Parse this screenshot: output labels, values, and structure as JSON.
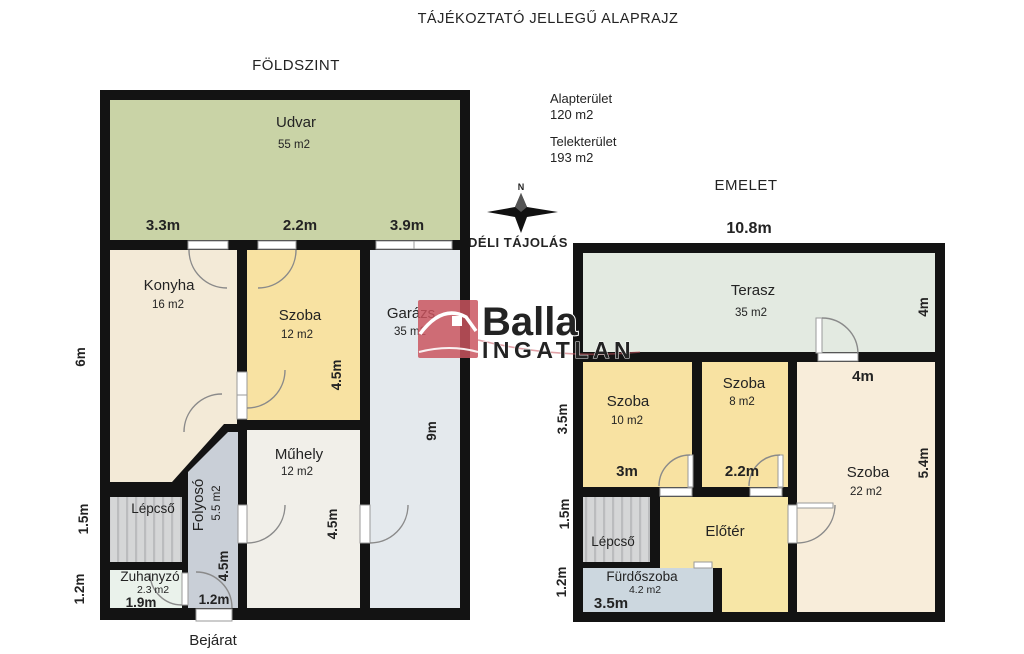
{
  "title": "TÁJÉKOZTATÓ JELLEGŰ ALAPRAJZ",
  "info": {
    "area_label": "Alapterület",
    "area_value": "120 m2",
    "lot_label": "Telekterület",
    "lot_value": "193 m2"
  },
  "compass": {
    "north": "N",
    "label": "DÉLI TÁJOLÁS"
  },
  "logo": {
    "brand": "Balla",
    "sub": "INGATLAN"
  },
  "ground": {
    "title": "FÖLDSZINT",
    "entrance": "Bejárat",
    "rooms": [
      {
        "name": "Udvar",
        "area": "55 m2"
      },
      {
        "name": "Konyha",
        "area": "16 m2"
      },
      {
        "name": "Szoba",
        "area": "12 m2"
      },
      {
        "name": "Garázs",
        "area": "35 m2"
      },
      {
        "name": "Műhely",
        "area": "12 m2"
      },
      {
        "name": "Folyosó",
        "area": "5.5 m2"
      },
      {
        "name": "Lépcső"
      },
      {
        "name": "Zuhanyzó",
        "area": "2.3 m2"
      }
    ],
    "dims": {
      "top": [
        "3.3m",
        "2.2m",
        "3.9m"
      ],
      "left": [
        "6m",
        "1.5m",
        "1.2m"
      ],
      "szoba_h": "4.5m",
      "muhely_h": "4.5m",
      "folyoso_h": "4.5m",
      "garazs_h": "9m",
      "zuhanyzo_w": "1.9m",
      "bejarat_w": "1.2m"
    }
  },
  "upper": {
    "title": "EMELET",
    "rooms": [
      {
        "name": "Terasz",
        "area": "35 m2"
      },
      {
        "name": "Szoba",
        "area": "10 m2"
      },
      {
        "name": "Szoba",
        "area": "8 m2"
      },
      {
        "name": "Szoba",
        "area": "22 m2"
      },
      {
        "name": "Előtér"
      },
      {
        "name": "Lépcső"
      },
      {
        "name": "Fürdőszoba",
        "area": "4.2 m2"
      }
    ],
    "dims": {
      "width": "10.8m",
      "left": [
        "3.5m",
        "1.5m",
        "1.2m"
      ],
      "terasz_h": "4m",
      "szoba22_top": "4m",
      "szoba22_h": "5.4m",
      "szoba10_w": "3m",
      "szoba8_w": "2.2m",
      "furdo_w": "3.5m"
    }
  },
  "colors": {
    "wall": "#131313",
    "udvar": "#c9d3a6",
    "konyha": "#f3ead7",
    "szoba_yellow": "#f8e2a2",
    "garazs": "#e4e9ed",
    "muhely": "#f1efe9",
    "folyoso": "#c9cfd7",
    "lepcso": "#d5d6d7",
    "zuhanyzo": "#eaf2eb",
    "terasz": "#e3eae1",
    "szoba22": "#f8edda",
    "eloter": "#f7e6a6",
    "furdoszoba": "#ccd7df",
    "logo_blue": "#2a6cb4",
    "logo_red": "#c9545e",
    "logo_pink": "#d4717b"
  }
}
